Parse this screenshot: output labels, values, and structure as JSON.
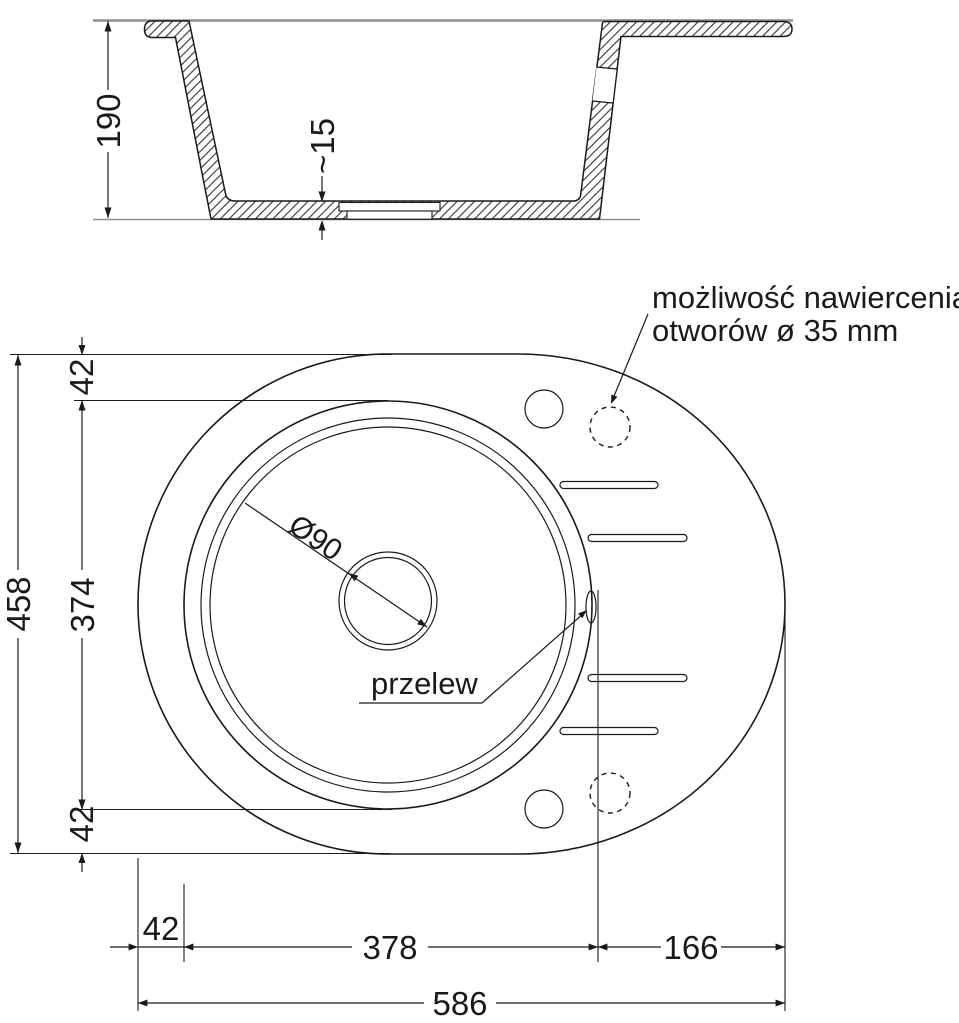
{
  "drawing": {
    "section": {
      "height_label": "190",
      "bottom_thickness_label": "~15"
    },
    "top_view": {
      "drain_label": "Ø90",
      "overflow_label": "przelew",
      "annotation_line1": "możliwość nawiercenia",
      "annotation_line2": "otworów ø 35 mm",
      "dims": {
        "left_total": "458",
        "left_inner": "374",
        "left_top": "42",
        "left_bottom": "42",
        "bottom_left": "42",
        "bottom_mid": "378",
        "bottom_right": "166",
        "bottom_total": "586"
      }
    },
    "colors": {
      "line": "#1a1a1a",
      "reference_line": "#8f8f8f",
      "background": "#ffffff"
    }
  }
}
